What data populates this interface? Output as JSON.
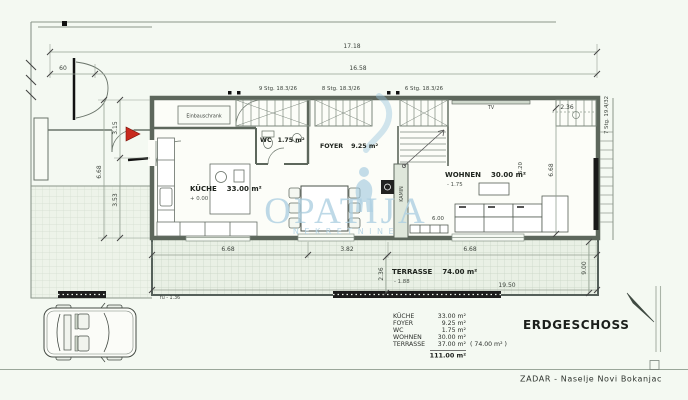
{
  "title": {
    "floor": "ERDGESCHOSS",
    "location": "ZADAR  -  Naselje  Novi  Bokanjac"
  },
  "watermark": {
    "word": "OPATIJA",
    "sub": "NEKRETNINE"
  },
  "rooms": {
    "kueche": {
      "name": "KÜCHE",
      "area": "33.00 m²",
      "level": "+ 0.00"
    },
    "wc": {
      "name": "WC",
      "area": "1.75 m²"
    },
    "foyer": {
      "name": "FOYER",
      "area": "9.25 m²"
    },
    "wohnen": {
      "name": "WOHNEN",
      "area": "30.00 m²",
      "level": "- 1.75"
    },
    "terrasse": {
      "name": "TERRASSE",
      "area": "74.00 m²",
      "level": "- 1.88"
    },
    "kamin": "KAMIN",
    "tv": "TV",
    "einbauschrank": "Einbauschrank"
  },
  "stairs": {
    "top_left": "9 Stg. 18.3/26",
    "top_mid": "8 Stg. 18.3/26",
    "top_right": "6 Stg. 18.3/26",
    "right_side": "7 Stg. 19.4/32"
  },
  "dimensions": {
    "total_width": "17.18",
    "inner_width": "16.58",
    "offset": "60",
    "left_upper": "3.15",
    "left_total": "6.68",
    "left_lower": "3.53",
    "kueche_width": "6.68",
    "mid_width": "3.82",
    "wohnen_width": "6.68",
    "terrasse_length": "19.50",
    "terrasse_depth": "2.36",
    "right_depth": "9.00",
    "top_right": "2.36",
    "wohnen_height": "6.68",
    "wohnen_inner": "6.20",
    "sofa_width": "6.00",
    "ground_level": "fu - 1.36"
  },
  "legend": {
    "rows": [
      {
        "label": "KÜCHE",
        "value": "33.00 m²"
      },
      {
        "label": "FOYER",
        "value": "9.25 m²"
      },
      {
        "label": "WC",
        "value": "1.75 m²"
      },
      {
        "label": "WOHNEN",
        "value": "30.00 m²"
      },
      {
        "label": "TERRASSE",
        "value": "37.00 m²",
        "extra": "( 74.00 m² )"
      }
    ],
    "total": "111.00 m²"
  }
}
